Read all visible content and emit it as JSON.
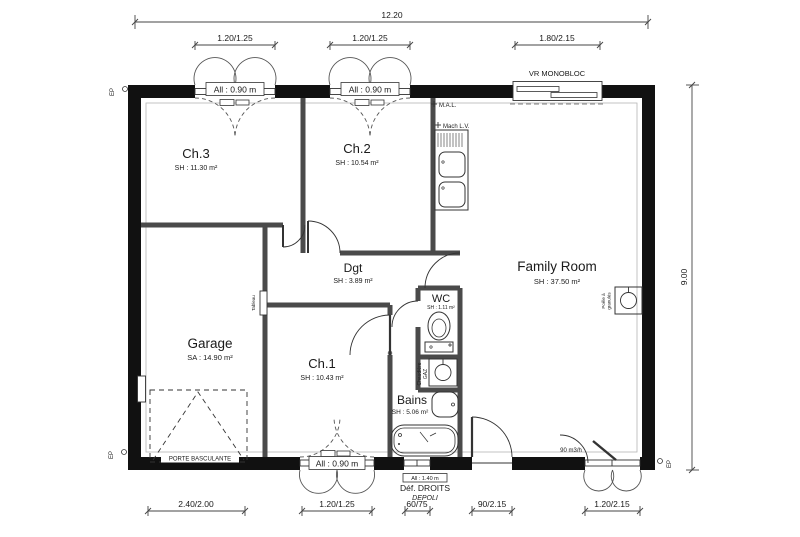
{
  "plan": {
    "rooms": [
      {
        "name": "Ch.3",
        "area": "SH : 11.30 m²"
      },
      {
        "name": "Ch.2",
        "area": "SH : 10.54 m²"
      },
      {
        "name": "Family Room",
        "area": "SH : 37.50 m²"
      },
      {
        "name": "Garage",
        "area": "SA : 14.90 m²"
      },
      {
        "name": "Dgt",
        "area": "SH : 3.89 m²"
      },
      {
        "name": "WC",
        "area": "SH : 1.11 m²"
      },
      {
        "name": "Ch.1",
        "area": "SH : 10.43 m²"
      },
      {
        "name": "Bains",
        "area": "SH : 5.06 m²"
      }
    ],
    "dimensions": {
      "overall_width": "12.20",
      "overall_height": "9.00",
      "top": [
        "1.20/1.25",
        "1.20/1.25",
        "1.80/2.15"
      ],
      "bottom": [
        "2.40/2.00",
        "1.20/1.25",
        "60/75",
        "90/2.15",
        "1.20/2.15"
      ]
    },
    "annotations": {
      "sill_090": "All : 0.90 m",
      "sill_140": "All : 1.40 m",
      "roller_shutter": "VR MONOBLOC",
      "washing_machine": "M.A.L.",
      "dishwasher": "Mach L.V.",
      "boiler_line1": "Chaudière",
      "boiler_line2": "GAZ",
      "stove_line1": "Poêle à",
      "stove_line2": "granulés",
      "electrical_panel": "Tableau",
      "garage_door": "PORTE BASCULANTE",
      "airflow": "90 m3/h",
      "glazing_note1": "Déf. DROITS",
      "glazing_note2": "DEPOLI",
      "rainwater": "EP"
    },
    "colors": {
      "wall": "#111111",
      "line": "#333333",
      "text": "#1a1a1a",
      "background": "#ffffff"
    }
  }
}
